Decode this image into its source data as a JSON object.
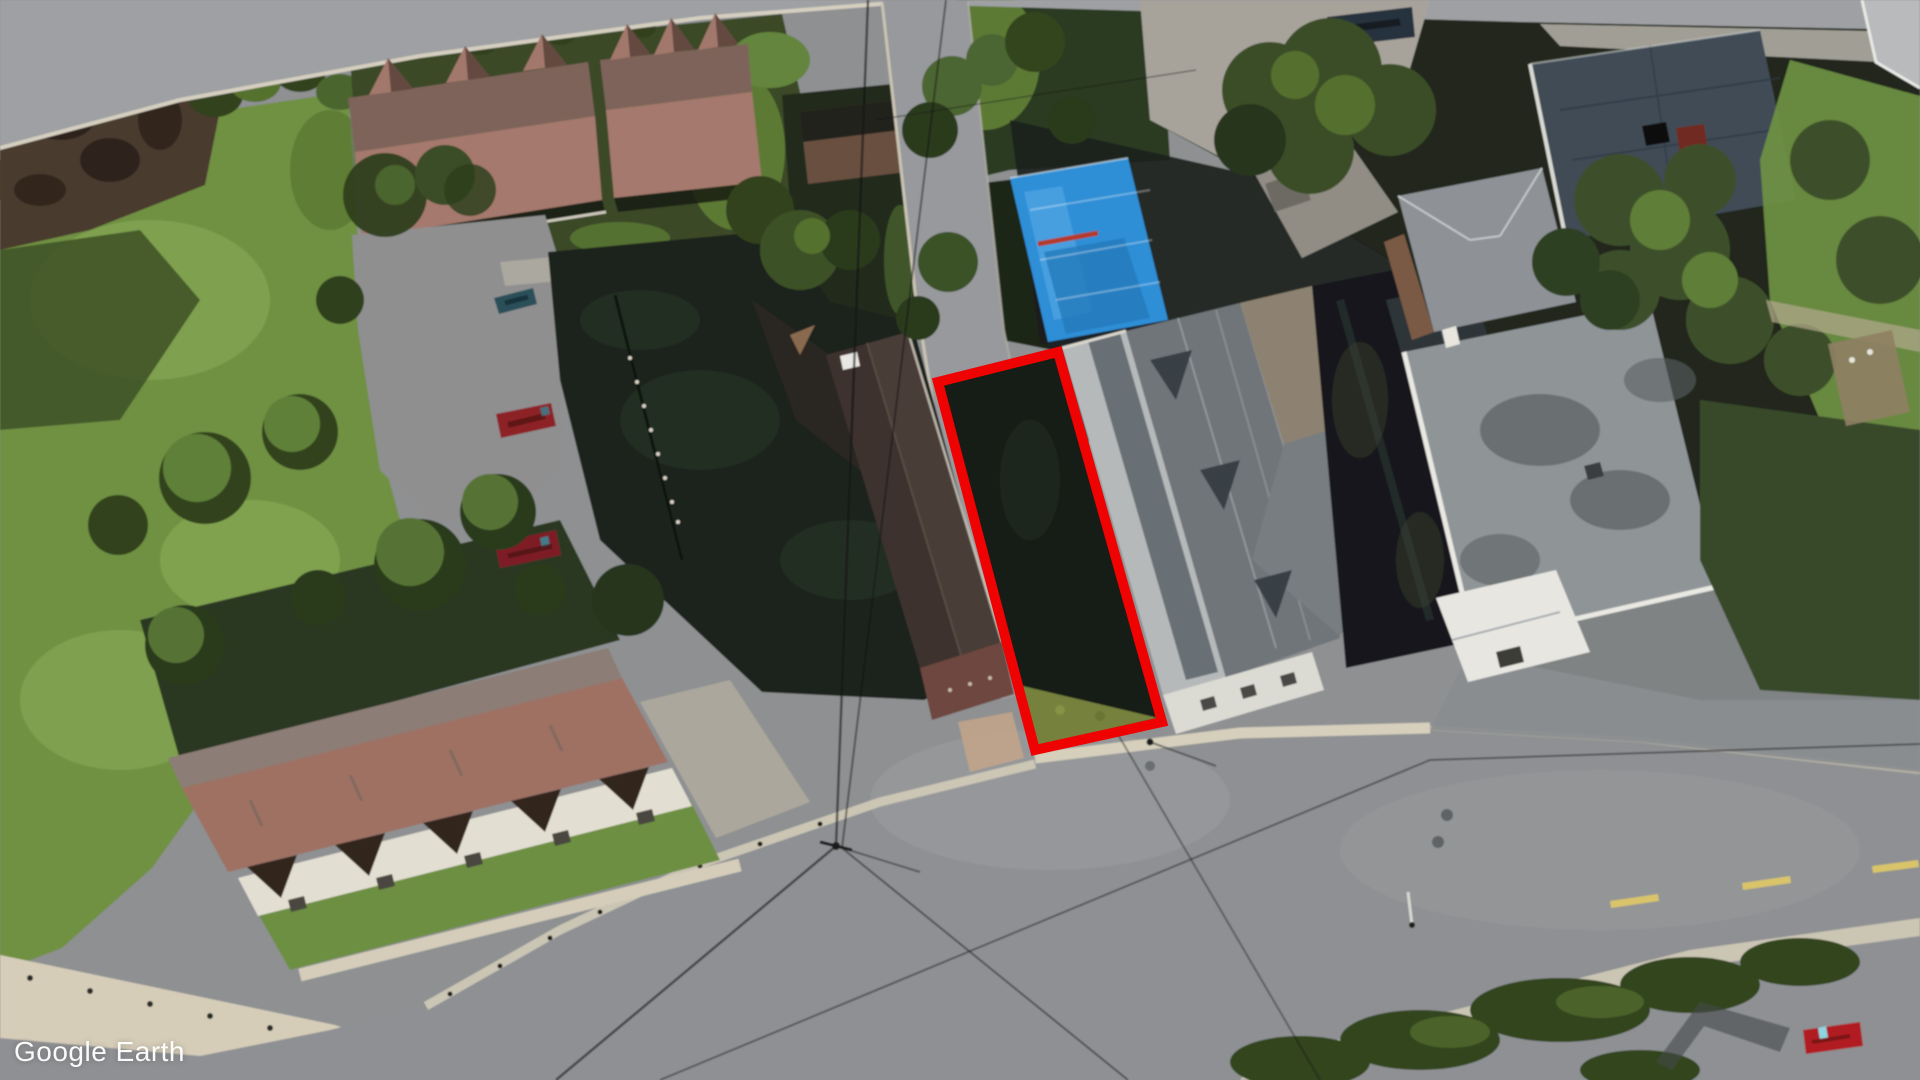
{
  "watermark": {
    "text": "Google Earth"
  },
  "scene": {
    "type": "satellite-aerial-photo",
    "highlight": {
      "name": "property-boundary-outline",
      "shape": "rotated-rectangle",
      "color": "#ee0202"
    },
    "notable_colors": {
      "blue_tarp": "#2e8ed6",
      "grass": "#6f9142",
      "road": "#919396",
      "north_townhouse_roof": "#a3786c",
      "south_townhouse_roof": "#9e7164",
      "dark_roof_building": "#4a3c37"
    },
    "features": [
      "excavated-dirt-patch",
      "yellow-excavator",
      "north-townhouse-row",
      "south-townhouse-row",
      "parking-lot-cars",
      "dark-brown-roof-building",
      "highlighted-vacant-lot",
      "blue-tarp-roof-building",
      "gray-gabled-house-complex",
      "flat-roof-warehouse",
      "dark-blue-flat-roof-building",
      "main-street",
      "side-street",
      "power-lines",
      "street-poles",
      "trees-and-hedges",
      "red-car-on-street"
    ]
  }
}
